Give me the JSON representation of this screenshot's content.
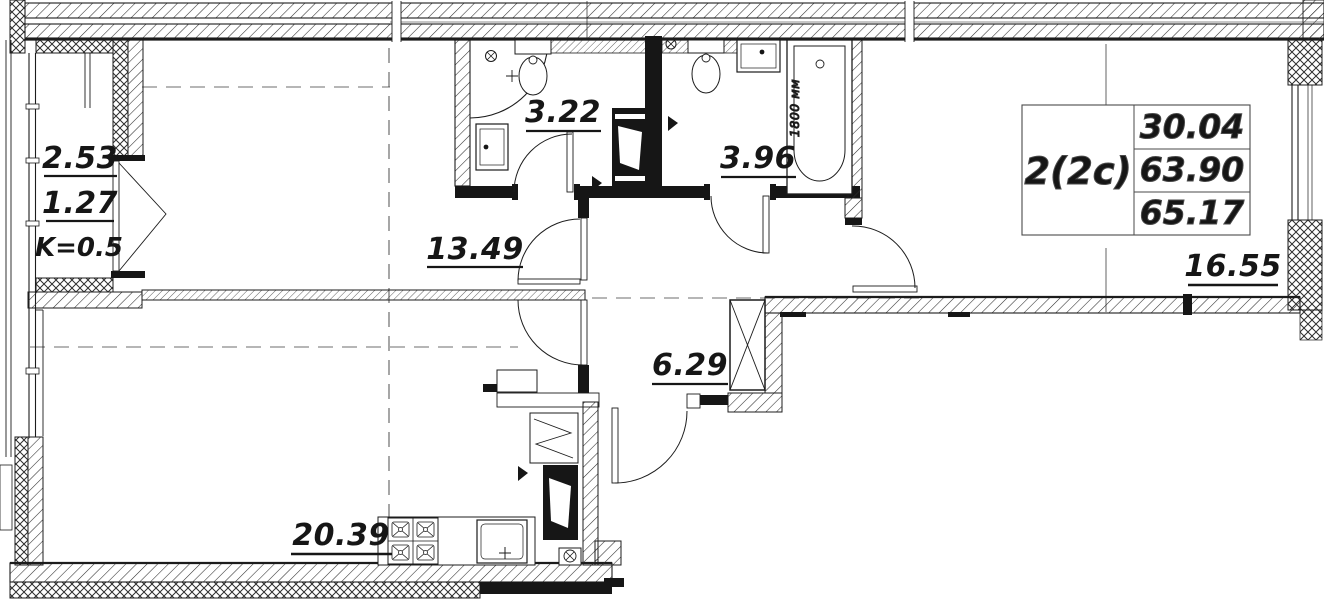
{
  "plan": {
    "unit": {
      "type_label": "2(2c)",
      "area_living": "30.04",
      "area_main": "63.90",
      "area_total": "65.17"
    },
    "areas": {
      "living_kitchen": "20.39",
      "room_a": "13.49",
      "room_b": "16.55",
      "hall": "6.29",
      "shower_room": "3.22",
      "bathroom": "3.96",
      "balcony_full": "2.53",
      "balcony_reduced": "1.27",
      "balcony_coefficient": "K=0.5"
    },
    "notes": {
      "bathtub_length": "1800 мм"
    },
    "colors": {
      "ink": "#1c1c1c",
      "paper": "#ffffff"
    }
  }
}
